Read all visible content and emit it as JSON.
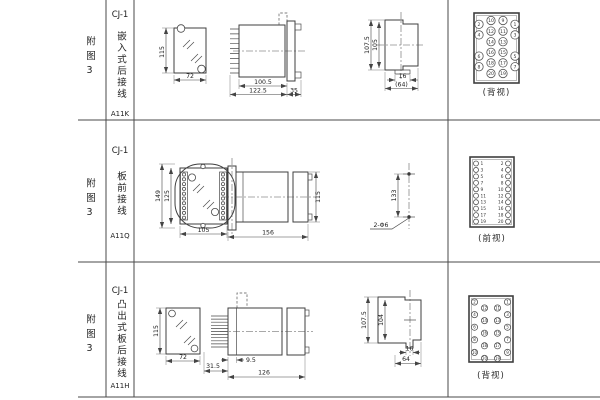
{
  "sheet_title": "CJ-1 relay outline and drilling dimension sheet",
  "colors": {
    "line": "#444444",
    "text": "#222222",
    "background": "#ffffff"
  },
  "table": {
    "rows": [
      {
        "fig_label": "附图3",
        "model": "CJ-1",
        "mounting_type": "嵌入式后接线",
        "code": "A11K",
        "view_caption": "(背视)",
        "dims": {
          "front_h": "115",
          "front_w": "72",
          "side_len1": "100.5",
          "side_len2": "122.5",
          "side_flange": "35",
          "cutout_h1": "107.5",
          "cutout_h2": "105",
          "cutout_w1": "16",
          "cutout_w2": "(64)"
        },
        "terminal_grid": [
          [
            "2",
            "10",
            "9",
            "1"
          ],
          [
            "4",
            "12",
            "11",
            "3"
          ],
          [
            "",
            "14",
            "13",
            ""
          ],
          [
            "6",
            "16",
            "15",
            "5"
          ],
          [
            "8",
            "18",
            "17",
            "7"
          ],
          [
            "",
            "20",
            "19",
            ""
          ]
        ]
      },
      {
        "fig_label": "附图3",
        "model": "CJ-1",
        "mounting_type": "板前接线",
        "code": "A11Q",
        "view_caption": "(前视)",
        "dims": {
          "front_h1": "149",
          "front_h2": "125",
          "front_w": "105",
          "side_len": "156",
          "side_h": "115",
          "hole_span": "133",
          "hole_label": "2-Φ6"
        },
        "left_terminals": [
          "1",
          "3",
          "5",
          "7",
          "9",
          "11",
          "13",
          "15",
          "17",
          "19"
        ],
        "right_terminals": [
          "2",
          "4",
          "6",
          "8",
          "10",
          "12",
          "14",
          "16",
          "18",
          "20"
        ]
      },
      {
        "fig_label": "附图3",
        "model": "CJ-1",
        "mounting_type": "凸出式板后接线",
        "code": "A11H",
        "view_caption": "(背视)",
        "dims": {
          "front_h": "115",
          "front_w": "72",
          "pin_len": "31.5",
          "side_offset": "9.5",
          "side_len": "126",
          "cutout_h1": "107.5",
          "cutout_h2": "104",
          "cutout_w1": "16",
          "cutout_w2": "64"
        },
        "terminal_groups": {
          "left_outer": [
            "2",
            "4",
            "6",
            "8",
            "10"
          ],
          "left_inner": [
            "12",
            "14",
            "16",
            "18",
            "20"
          ],
          "right_inner": [
            "11",
            "13",
            "15",
            "17",
            "19"
          ],
          "right_outer": [
            "1",
            "3",
            "5",
            "7",
            "9"
          ]
        }
      }
    ]
  }
}
